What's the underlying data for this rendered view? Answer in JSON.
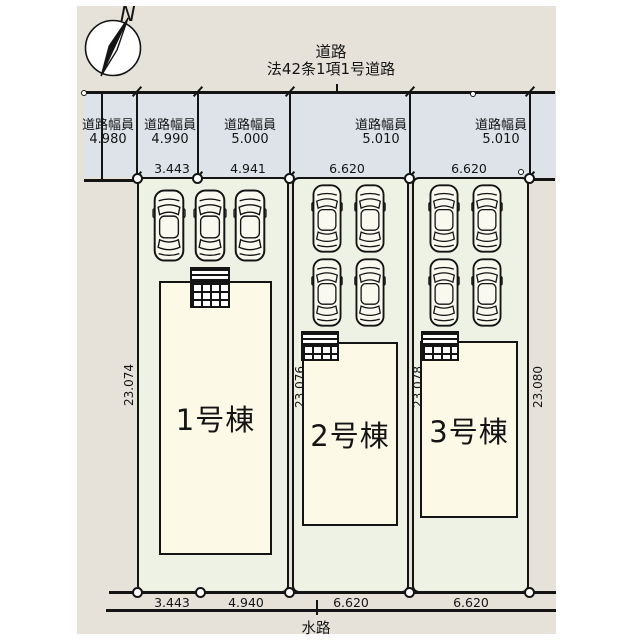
{
  "plan": {
    "north_label": "N",
    "road": {
      "name": "道路",
      "law": "法42条1項1号道路",
      "width_caption": "道路幅員",
      "widths": [
        "4.980",
        "4.990",
        "5.000",
        "5.010",
        "5.010"
      ],
      "front_dims": [
        "3.443",
        "4.941",
        "6.620",
        "6.620"
      ]
    },
    "buildings": [
      "1号棟",
      "2号棟",
      "3号棟"
    ],
    "depth_dims": [
      "23.074",
      "23.076",
      "23.078",
      "23.080"
    ],
    "bottom_dims": [
      "3.443",
      "4.940",
      "6.620",
      "6.620"
    ],
    "waterway": "水路",
    "colors": {
      "panel_bg": "#e6e2da",
      "road_bg": "#dde3e9",
      "lot_bg": "#eef2e5",
      "building_bg": "#fcf9e7",
      "line": "#141414"
    }
  }
}
